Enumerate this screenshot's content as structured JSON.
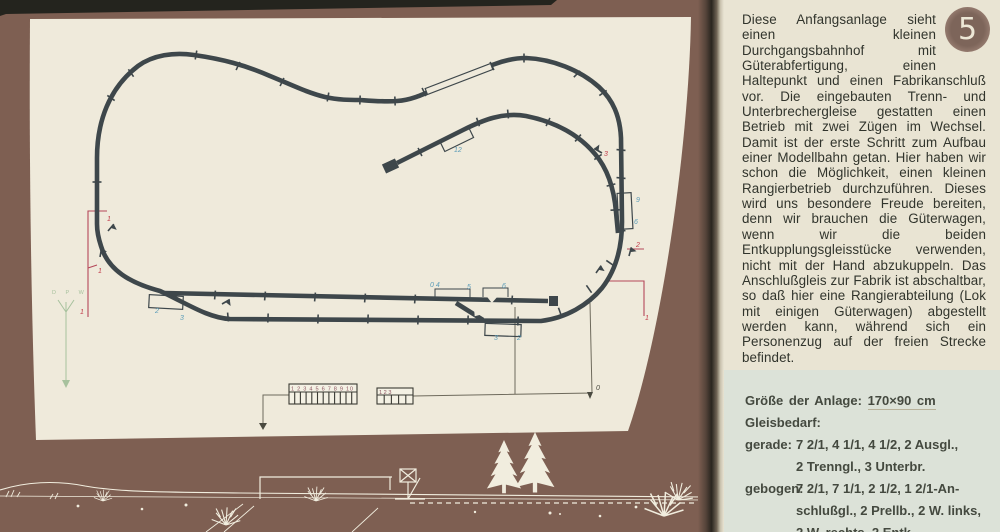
{
  "page_number": "5",
  "description": "Diese Anfangsanlage sieht einen kleinen Durchgangsbahnhof mit Güterabfertigung, einen Haltepunkt und einen Fabrikanschluß vor. Die eingebauten Trenn- und Unterbrechergleise gestatten einen Betrieb mit zwei Zügen im Wechsel. Damit ist der erste Schritt zum Aufbau einer Modellbahn getan. Hier haben wir schon die Möglichkeit, einen kleinen Rangierbetrieb durchzuführen. Dieses wird uns besondere Freude bereiten, denn wir brauchen die Güterwagen, wenn wir die beiden Entkupplungsgleisstücke verwenden, nicht mit der Hand abzukuppeln. Das Anschlußgleis zur Fabrik ist abschaltbar, so daß hier eine Rangierabteilung (Lok mit einigen Güterwagen) abgestellt werden kann, während sich ein Personenzug auf der freien Strecke befindet.",
  "info_box": {
    "size_label": "Größe der Anlage:",
    "size_value": "170×90 cm",
    "needs_label": "Gleisbedarf:",
    "rows": [
      {
        "label": "gerade:",
        "value": "7 2/1, 4 1/1, 4 1/2, 2 Ausgl.,\n2 Trenngl., 3 Unterbr."
      },
      {
        "label": "gebogen:",
        "value": "7 2/1, 7 1/1, 2 1/2, 1 2/1-An-\nschlußgl., 2 Prellb., 2 W. links,\n2 W. rechts, 2 Entk."
      }
    ]
  },
  "plan": {
    "track_labels": {
      "b2": "2",
      "b3": "3",
      "b12": "12",
      "b9": "9",
      "b6": "6",
      "b04": "0 4",
      "b5": "5",
      "b6s": "6",
      "b3b": "3",
      "b2b": "2",
      "feed0": "0",
      "r1a": "1",
      "r1b": "1",
      "r1c": "1",
      "r3": "3",
      "r2": "2",
      "r1d": "1"
    },
    "panel1_numbers": "1 2 3 4 5 6 7 8 9 10",
    "panel2_numbers": "1 2 3",
    "signal_letters": "D P W"
  },
  "colors": {
    "page_brown": "#7e5f52",
    "plan_panel": "#efeadb",
    "right_page": "#e9e4d3",
    "info_box": "#dce2d8",
    "track": "#3e474b",
    "wire_red": "#b5485a",
    "label_blue": "#5b9cb8",
    "art_white": "#f1edde"
  }
}
